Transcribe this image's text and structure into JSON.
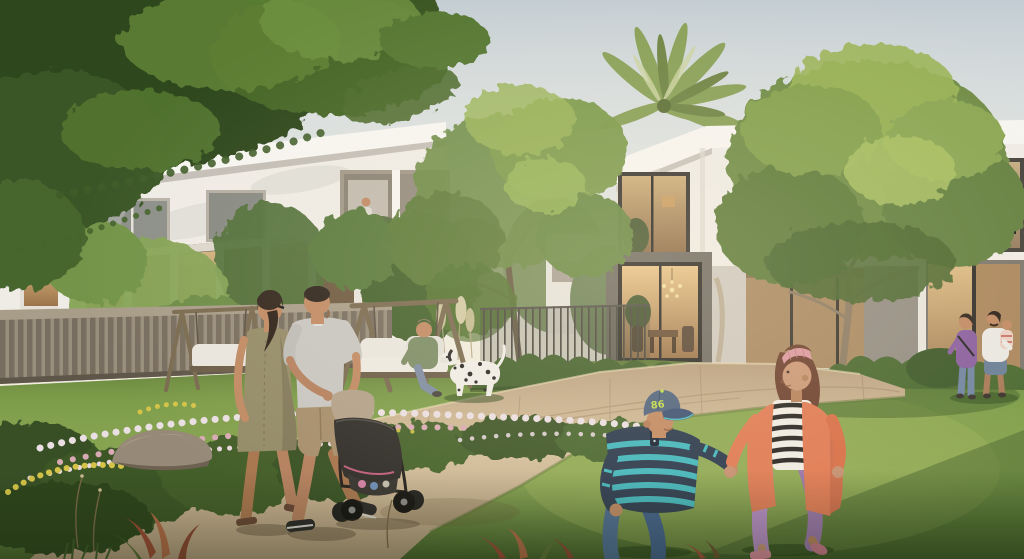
{
  "scene": {
    "type": "architectural-rendering",
    "description": "Sunlit residential community: two modern white two-storey villas with warm lit glass facades, palm and leafy trees, a green lawn crossed by a curved beige stone path. A couple pushes a baby stroller along the path, two children run holding hands on the grass, a woman sits on a wooden swing bench beside a Dalmatian, and a small family stands by the right villa.",
    "cap": {
      "text": "86"
    }
  },
  "annotations": [
    {
      "name": "sky",
      "label": "pale hazy morning sky"
    },
    {
      "name": "overhanging-canopy",
      "label": "dark green tree canopy overhanging top-left corner"
    },
    {
      "name": "palm-tree",
      "label": "palm crown rising behind the right villa parapet"
    },
    {
      "name": "left-villa",
      "label": "white two-storey villa with lit ground-floor glazing and recessed balcony"
    },
    {
      "name": "balcony-person",
      "label": "resident standing on balcony behind olive planter"
    },
    {
      "name": "right-villa",
      "label": "white villa with dark-framed windows, TV glow and glass lounge with chandelier"
    },
    {
      "name": "big-tree-right",
      "label": "large olive-green tree in front of right villa"
    },
    {
      "name": "tree-center",
      "label": "airy green tree between the villas"
    },
    {
      "name": "wooden-fence",
      "label": "slatted timber fence along left garden"
    },
    {
      "name": "metal-fence",
      "label": "thin vertical-bar fence with pampas grass"
    },
    {
      "name": "flower-bed",
      "label": "white, pink and yellow flower bed with rock"
    },
    {
      "name": "swing-benches",
      "label": "two timber A-frame swing benches with white cushions"
    },
    {
      "name": "seated-woman",
      "label": "woman in green top seated on swing bench"
    },
    {
      "name": "dalmatian-dog",
      "label": "Dalmatian standing on the lawn"
    },
    {
      "name": "walking-woman",
      "label": "woman in olive dress walking on path"
    },
    {
      "name": "walking-man",
      "label": "man in grey polo pushing stroller"
    },
    {
      "name": "baby-stroller",
      "label": "dark stroller with beige canopy"
    },
    {
      "name": "boy-child",
      "label": "boy in striped teal shirt, jeans and denim cap numbered 86"
    },
    {
      "name": "girl-child",
      "label": "girl in coral cardigan, striped top, lilac pants and pink headband"
    },
    {
      "name": "family-by-house",
      "label": "couple with toddler by the right villa glazing"
    },
    {
      "name": "garden-path",
      "label": "curved beige paving sweeping from foreground to the right"
    },
    {
      "name": "lawn",
      "label": "sunlit green lawn"
    }
  ],
  "palette": {
    "sky_base": "#dce1e0",
    "grass_mid": "#7b9a4a",
    "path_base": "#cdb795",
    "facade_white": "#efece6",
    "fascia": "#f7f5f1",
    "grey_volume": "#716c64",
    "glass_warm": "#c79b66",
    "fence_wood": "#8f8573",
    "hedge": "#45622e",
    "shrub_dark": "#374f26",
    "flower_white": "#eadfe2",
    "flower_pink": "#d8abb4",
    "flower_yellow": "#d4c348",
    "rock": "#968977",
    "swing_wood": "#7a6a50",
    "cushion": "#e9e6df",
    "skin": "#c08a64",
    "hair_dark": "#33261d",
    "dress_olive": "#948b68",
    "polo_grey": "#c8c6c2",
    "shorts_khaki": "#a78f6d",
    "shoe_dark": "#2e2b2a",
    "stroller_body": "#322f2b",
    "stroller_canopy": "#b3a28a",
    "boy_cap": "#51647f",
    "boy_navy": "#2e3c4f",
    "boy_teal": "#45b7bd",
    "boy_jeans": "#4e6d92",
    "cap_text": "#c3dc4a",
    "girl_coral": "#e07c55",
    "girl_lilac": "#b58cc2",
    "girl_headband": "#dc98a0",
    "girl_hair": "#6e4230",
    "top_white": "#f0ece3",
    "stripe_dark": "#2a2724",
    "dog_white": "#efede7",
    "dalmatian_spot": "#262423",
    "purple_top": "#8a5f9e",
    "denim": "#6b7f96",
    "white_tee": "#eae8e3",
    "jeans_blue": "#7285a2",
    "canopy_dark": "#33491f",
    "tree_mid": "#6f8c46",
    "tree_light": "#9ab457",
    "palm_green": "#88a057"
  }
}
